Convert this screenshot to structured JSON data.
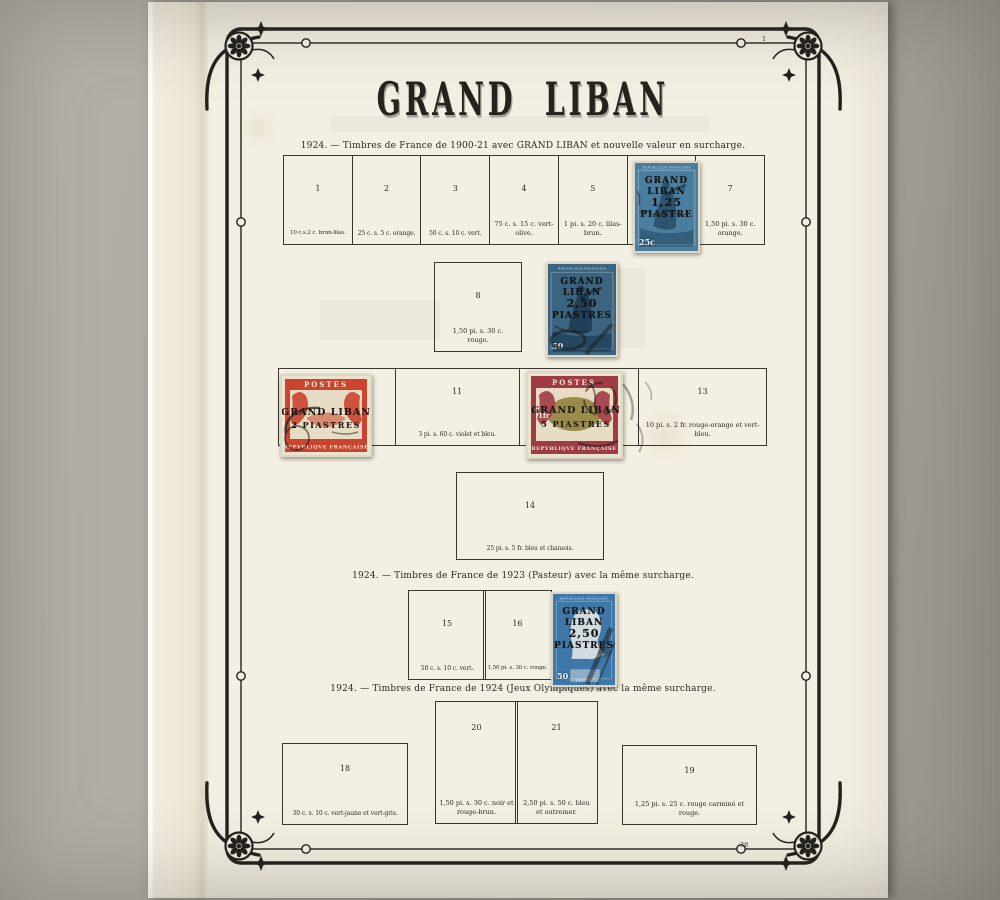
{
  "page": {
    "title": "GRAND LIBAN",
    "corner_number_top": "1",
    "corner_number_bottom": "38"
  },
  "sections": [
    {
      "heading": "1924. — Timbres de France de 1900-21 avec GRAND LIBAN et nouvelle valeur en surcharge."
    },
    {
      "heading": "1924. — Timbres de France de 1923 (Pasteur) avec la même surcharge."
    },
    {
      "heading": "1924. — Timbres de France de 1924 (Jeux Olympiques) avec la même surcharge."
    }
  ],
  "boxes": {
    "b1": {
      "number": "1",
      "caption": "10 c.s.2 c. brun-lilas."
    },
    "b2": {
      "number": "2",
      "caption": "25 c. s. 5 c. orange."
    },
    "b3": {
      "number": "3",
      "caption": "50 c. s. 10 c. vert."
    },
    "b4": {
      "number": "4",
      "caption": "75 c. s. 15 c. vert-olive."
    },
    "b5": {
      "number": "5",
      "caption": "1 pi. s. 20 c. lilas-brun."
    },
    "b7": {
      "number": "7",
      "caption": "1,50 pi. s. 30 c. orange."
    },
    "b8": {
      "number": "8",
      "caption": "1,50 pi. s. 30 c. rouge."
    },
    "b11": {
      "number": "11",
      "caption": "3 pi. s. 60 c. violet et bleu."
    },
    "b13": {
      "number": "13",
      "caption": "10 pi. s. 2 fr. rouge-orange et vert-bleu."
    },
    "b14": {
      "number": "14",
      "caption": "25 pi. s. 5 fr. bleu et chamois."
    },
    "b15": {
      "number": "15",
      "caption": "50 c. s. 10 c. vert."
    },
    "b16": {
      "number": "16",
      "caption": "1,50 pi. s. 30 c. rouge."
    },
    "b18": {
      "number": "18",
      "caption": "30 c. s. 10 c. vert-jaune et vert-gris."
    },
    "b19": {
      "number": "19",
      "caption": "1,25 pi. s. 25 c. rouge carminé et rouge."
    },
    "b20": {
      "number": "20",
      "caption": "1,50 pi. s. 30 c. noir et rouge-brun."
    },
    "b21": {
      "number": "21",
      "caption": "2,50 pi. s. 50 c. bleu et outremer."
    }
  },
  "stamps": {
    "semeuse_125": {
      "country": "REPUBLIQUE FRANÇAISE",
      "overprint": [
        "GRAND",
        "LIBAN",
        "1,25",
        "PIASTRE"
      ],
      "value": "25c"
    },
    "semeuse_250": {
      "country": "REPUBLIQUE FRANÇAISE",
      "overprint": [
        "GRAND",
        "LIBAN",
        "2,50",
        "PIASTRES"
      ],
      "value": "50"
    },
    "merson_2p": {
      "top": "POSTES",
      "overprint": [
        "GRAND LIBAN",
        "2 PIASTRES"
      ],
      "bottom": "REPVBLIQVE FRANÇAISE"
    },
    "merson_5p": {
      "top": "POSTES",
      "overprint": [
        "GRAND LIBAN",
        "5 PIASTRES"
      ],
      "bottom": "REPVBLIQVE FRANÇAISE",
      "value": "1fr"
    },
    "pasteur_250": {
      "country": "REPUBLIQUE FRANÇAISE",
      "overprint": [
        "GRAND",
        "LIBAN",
        "2,50",
        "PIASTRES"
      ],
      "value": "50",
      "label": "PASTEUR"
    }
  },
  "colors": {
    "page_paper": "#f3efe2",
    "frame_ink": "#23211d",
    "semeuse25_blue": "#4a7ea1",
    "semeuse50_blue": "#3a6480",
    "merson_red": "#cb4430",
    "merson_claret": "#a03a45",
    "merson_olive": "#8c7c35",
    "pasteur_blue": "#3f78a8"
  }
}
